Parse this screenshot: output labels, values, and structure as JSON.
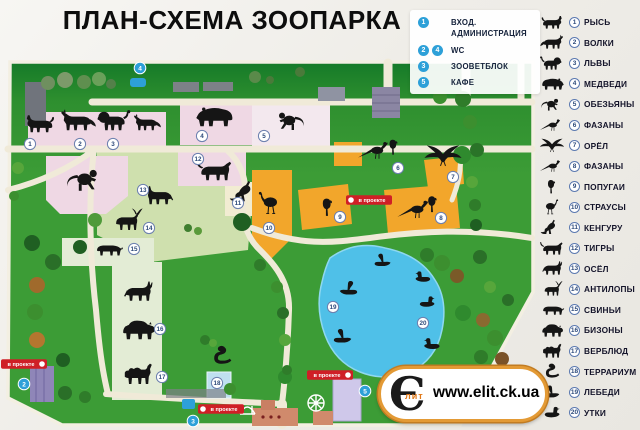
{
  "title": "ПЛАН-СХЕМА ЗООПАРКА",
  "watermark": {
    "logo_letter": "Є",
    "logo_sub": "лит",
    "url": "www.elit.ck.ua"
  },
  "facilities_legend": {
    "items": [
      {
        "numbers": [
          "1"
        ],
        "label": "ВХОД. АДМИНИСТРАЦИЯ"
      },
      {
        "numbers": [
          "2",
          "4"
        ],
        "label": "WC"
      },
      {
        "numbers": [
          "3"
        ],
        "label": "ЗООВЕТБЛОК"
      },
      {
        "numbers": [
          "5"
        ],
        "label": "КАФЕ"
      }
    ]
  },
  "animals_legend": {
    "items": [
      {
        "number": "1",
        "label": "РЫСЬ",
        "shape": "lynx"
      },
      {
        "number": "2",
        "label": "ВОЛКИ",
        "shape": "wolf"
      },
      {
        "number": "3",
        "label": "ЛЬВЫ",
        "shape": "lion"
      },
      {
        "number": "4",
        "label": "МЕДВЕДИ",
        "shape": "bear"
      },
      {
        "number": "5",
        "label": "ОБЕЗЬЯНЫ",
        "shape": "monkey"
      },
      {
        "number": "6",
        "label": "ФАЗАНЫ",
        "shape": "pheasant"
      },
      {
        "number": "7",
        "label": "ОРЁЛ",
        "shape": "eagle"
      },
      {
        "number": "8",
        "label": "ФАЗАНЫ",
        "shape": "pheasant"
      },
      {
        "number": "9",
        "label": "ПОПУГАИ",
        "shape": "parrot"
      },
      {
        "number": "10",
        "label": "СТРАУСЫ",
        "shape": "ostrich"
      },
      {
        "number": "11",
        "label": "КЕНГУРУ",
        "shape": "kangaroo"
      },
      {
        "number": "12",
        "label": "ТИГРЫ",
        "shape": "tiger"
      },
      {
        "number": "13",
        "label": "ОСЁЛ",
        "shape": "donkey"
      },
      {
        "number": "14",
        "label": "АНТИЛОПЫ",
        "shape": "antelope"
      },
      {
        "number": "15",
        "label": "СВИНЬИ",
        "shape": "pig"
      },
      {
        "number": "16",
        "label": "БИЗОНЫ",
        "shape": "bison"
      },
      {
        "number": "17",
        "label": "ВЕРБЛЮД",
        "shape": "camel"
      },
      {
        "number": "18",
        "label": "ТЕРРАРИУМ",
        "shape": "cobra"
      },
      {
        "number": "19",
        "label": "ЛЕБЕДИ",
        "shape": "swan"
      },
      {
        "number": "20",
        "label": "УТКИ",
        "shape": "duck"
      }
    ]
  },
  "map": {
    "project_label": "в проекте",
    "colors": {
      "grass": "#3c9c36",
      "grass_dark": "#157a28",
      "path": "#f0ead8",
      "enclosure_pink": "#efd8e4",
      "enclosure_orange": "#f2a62b",
      "pond_blue": "#4fc0e8",
      "marker_blue": "#2da0d8",
      "label_red": "#cf1f26"
    },
    "animal_markers": [
      {
        "number": "1",
        "x": 30,
        "y": 144
      },
      {
        "number": "2",
        "x": 80,
        "y": 144
      },
      {
        "number": "3",
        "x": 113,
        "y": 144
      },
      {
        "number": "4",
        "x": 202,
        "y": 136
      },
      {
        "number": "5",
        "x": 264,
        "y": 136
      },
      {
        "number": "6",
        "x": 398,
        "y": 168
      },
      {
        "number": "7",
        "x": 453,
        "y": 177
      },
      {
        "number": "8",
        "x": 441,
        "y": 218
      },
      {
        "number": "9",
        "x": 340,
        "y": 217
      },
      {
        "number": "10",
        "x": 269,
        "y": 228
      },
      {
        "number": "11",
        "x": 238,
        "y": 203
      },
      {
        "number": "12",
        "x": 198,
        "y": 159
      },
      {
        "number": "13",
        "x": 143,
        "y": 190
      },
      {
        "number": "14",
        "x": 149,
        "y": 228
      },
      {
        "number": "15",
        "x": 134,
        "y": 249
      },
      {
        "number": "16",
        "x": 160,
        "y": 329
      },
      {
        "number": "17",
        "x": 162,
        "y": 377
      },
      {
        "number": "18",
        "x": 217,
        "y": 383
      },
      {
        "number": "19",
        "x": 333,
        "y": 307
      },
      {
        "number": "20",
        "x": 423,
        "y": 323
      }
    ],
    "facility_markers": [
      {
        "number": "4",
        "x": 140,
        "y": 68
      },
      {
        "number": "2",
        "x": 24,
        "y": 384
      },
      {
        "number": "3",
        "x": 193,
        "y": 421
      },
      {
        "number": "5",
        "x": 365,
        "y": 391
      }
    ],
    "project_labels": [
      {
        "x": 369,
        "y": 200,
        "dot": "left"
      },
      {
        "x": 24,
        "y": 364,
        "dot": "right"
      },
      {
        "x": 221,
        "y": 409,
        "dot": "left"
      },
      {
        "x": 330,
        "y": 375,
        "dot": "right"
      }
    ],
    "silhouettes": [
      {
        "shape": "lynx",
        "x": 40,
        "y": 124,
        "s": 0.55,
        "flip": true
      },
      {
        "shape": "wolf",
        "x": 78,
        "y": 121,
        "s": 0.62,
        "flip": true
      },
      {
        "shape": "lion",
        "x": 112,
        "y": 121,
        "s": 0.62,
        "flip": true
      },
      {
        "shape": "wolf",
        "x": 147,
        "y": 123,
        "s": 0.48,
        "flip": true
      },
      {
        "shape": "bear",
        "x": 216,
        "y": 116,
        "s": 0.68,
        "flip": true
      },
      {
        "shape": "monkey",
        "x": 288,
        "y": 121,
        "s": 0.6,
        "flip": true
      },
      {
        "shape": "monkey",
        "x": 86,
        "y": 180,
        "s": 0.72,
        "flip": false
      },
      {
        "shape": "tiger",
        "x": 215,
        "y": 171,
        "s": 0.62,
        "flip": false
      },
      {
        "shape": "kangaroo",
        "x": 246,
        "y": 192,
        "s": 0.58,
        "flip": false
      },
      {
        "shape": "ostrich",
        "x": 268,
        "y": 204,
        "s": 0.6,
        "flip": true
      },
      {
        "shape": "parrot",
        "x": 328,
        "y": 207,
        "s": 0.52,
        "flip": false
      },
      {
        "shape": "pheasant",
        "x": 376,
        "y": 151,
        "s": 0.6,
        "flip": false
      },
      {
        "shape": "parrot",
        "x": 394,
        "y": 147,
        "s": 0.45,
        "flip": false
      },
      {
        "shape": "eagle",
        "x": 443,
        "y": 156,
        "s": 0.62,
        "flip": false
      },
      {
        "shape": "pheasant",
        "x": 416,
        "y": 210,
        "s": 0.62,
        "flip": false
      },
      {
        "shape": "parrot",
        "x": 433,
        "y": 204,
        "s": 0.48,
        "flip": false
      },
      {
        "shape": "donkey",
        "x": 160,
        "y": 196,
        "s": 0.55,
        "flip": true
      },
      {
        "shape": "antelope",
        "x": 127,
        "y": 221,
        "s": 0.6,
        "flip": false
      },
      {
        "shape": "pig",
        "x": 108,
        "y": 249,
        "s": 0.5,
        "flip": false
      },
      {
        "shape": "donkey",
        "x": 138,
        "y": 292,
        "s": 0.58,
        "flip": false
      },
      {
        "shape": "bison",
        "x": 138,
        "y": 330,
        "s": 0.62,
        "flip": false
      },
      {
        "shape": "camel",
        "x": 138,
        "y": 375,
        "s": 0.6,
        "flip": false
      },
      {
        "shape": "cobra",
        "x": 222,
        "y": 356,
        "s": 0.52,
        "flip": false
      },
      {
        "shape": "swan",
        "x": 383,
        "y": 261,
        "s": 0.42,
        "flip": false
      },
      {
        "shape": "swan",
        "x": 348,
        "y": 289,
        "s": 0.46,
        "flip": true
      },
      {
        "shape": "swan",
        "x": 343,
        "y": 337,
        "s": 0.46,
        "flip": false
      },
      {
        "shape": "duck",
        "x": 423,
        "y": 277,
        "s": 0.4,
        "flip": true
      },
      {
        "shape": "duck",
        "x": 427,
        "y": 302,
        "s": 0.4,
        "flip": false
      },
      {
        "shape": "duck",
        "x": 432,
        "y": 344,
        "s": 0.42,
        "flip": true
      },
      {
        "shape": "duck",
        "x": 428,
        "y": 371,
        "s": 0.4,
        "flip": false
      }
    ]
  }
}
